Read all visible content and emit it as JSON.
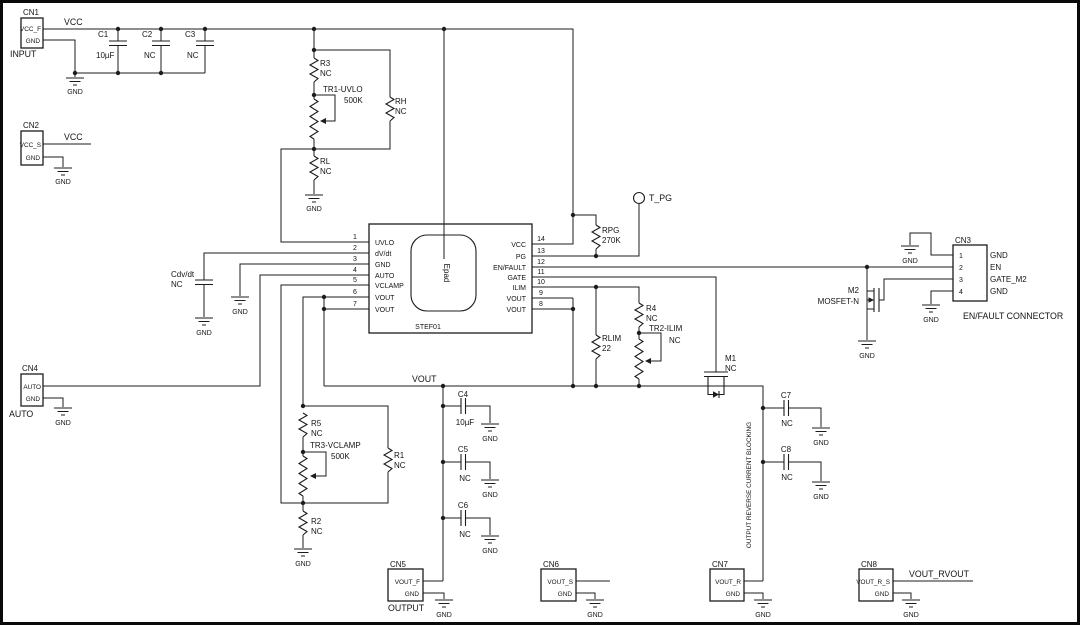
{
  "gnd": "GND",
  "nets": {
    "vcc_in": "VCC",
    "vcc_sense": "VCC",
    "vout": "VOUT",
    "vout_rvout": "VOUT_RVOUT",
    "t_pg": "T_PG"
  },
  "notes": {
    "reverse_block": "OUTPUT REVERSE CURRENT BLOCKING"
  },
  "cn1": {
    "name": "CN1",
    "pin1": "VCC_F",
    "pin2": "GND",
    "caption": "INPUT"
  },
  "cn2": {
    "name": "CN2",
    "pin1": "VCC_S",
    "pin2": "GND"
  },
  "cn3": {
    "name": "CN3",
    "pins": [
      {
        "n": "1",
        "l": "GND"
      },
      {
        "n": "2",
        "l": "EN"
      },
      {
        "n": "3",
        "l": "GATE_M2"
      },
      {
        "n": "4",
        "l": "GND"
      }
    ],
    "caption": "EN/FAULT CONNECTOR"
  },
  "cn4": {
    "name": "CN4",
    "pin1": "AUTO",
    "pin2": "GND",
    "caption": "AUTO"
  },
  "cn5": {
    "name": "CN5",
    "pin1": "VOUT_F",
    "pin2": "GND",
    "caption": "OUTPUT"
  },
  "cn6": {
    "name": "CN6",
    "pin1": "VOUT_S",
    "pin2": "GND"
  },
  "cn7": {
    "name": "CN7",
    "pin1": "VOUT_R",
    "pin2": "GND"
  },
  "cn8": {
    "name": "CN8",
    "pin1": "VOUT_R_S",
    "pin2": "GND"
  },
  "ic": {
    "part": "STEF01",
    "epad": "Epad",
    "lp": [
      {
        "n": "1",
        "l": "UVLO"
      },
      {
        "n": "2",
        "l": "dV/dt"
      },
      {
        "n": "3",
        "l": "GND"
      },
      {
        "n": "4",
        "l": "AUTO"
      },
      {
        "n": "5",
        "l": "VCLAMP"
      },
      {
        "n": "6",
        "l": "VOUT"
      },
      {
        "n": "7",
        "l": "VOUT"
      }
    ],
    "rp": [
      {
        "n": "14",
        "l": "VCC"
      },
      {
        "n": "13",
        "l": "PG"
      },
      {
        "n": "12",
        "l": "EN/FAULT"
      },
      {
        "n": "11",
        "l": "GATE"
      },
      {
        "n": "10",
        "l": "ILIM"
      },
      {
        "n": "9",
        "l": "VOUT"
      },
      {
        "n": "8",
        "l": "VOUT"
      }
    ]
  },
  "caps": {
    "c1": {
      "ref": "C1",
      "val": "10µF"
    },
    "c2": {
      "ref": "C2",
      "val": "NC"
    },
    "c3": {
      "ref": "C3",
      "val": "NC"
    },
    "c4": {
      "ref": "C4",
      "val": "10µF"
    },
    "c5": {
      "ref": "C5",
      "val": "NC"
    },
    "c6": {
      "ref": "C6",
      "val": "NC"
    },
    "c7": {
      "ref": "C7",
      "val": "NC"
    },
    "c8": {
      "ref": "C8",
      "val": "NC"
    },
    "cdvdt": {
      "ref": "Cdv/dt",
      "val": "NC"
    }
  },
  "res": {
    "r1": {
      "ref": "R1",
      "val": "NC"
    },
    "r2": {
      "ref": "R2",
      "val": "NC"
    },
    "r3": {
      "ref": "R3",
      "val": "NC"
    },
    "r4": {
      "ref": "R4",
      "val": "NC"
    },
    "r5": {
      "ref": "R5",
      "val": "NC"
    },
    "rh": {
      "ref": "RH",
      "val": "NC"
    },
    "rl": {
      "ref": "RL",
      "val": "NC"
    },
    "rlim": {
      "ref": "RLIM",
      "val": "22"
    },
    "rpg": {
      "ref": "RPG",
      "val": "270K"
    }
  },
  "trim": {
    "tr1": {
      "ref": "TR1-UVLO",
      "val": "500K"
    },
    "tr2": {
      "ref": "TR2-ILIM",
      "val": "NC"
    },
    "tr3": {
      "ref": "TR3-VCLAMP",
      "val": "500K"
    }
  },
  "fets": {
    "m1": {
      "ref": "M1",
      "val": "NC"
    },
    "m2": {
      "ref": "M2",
      "val": "MOSFET-N"
    }
  }
}
